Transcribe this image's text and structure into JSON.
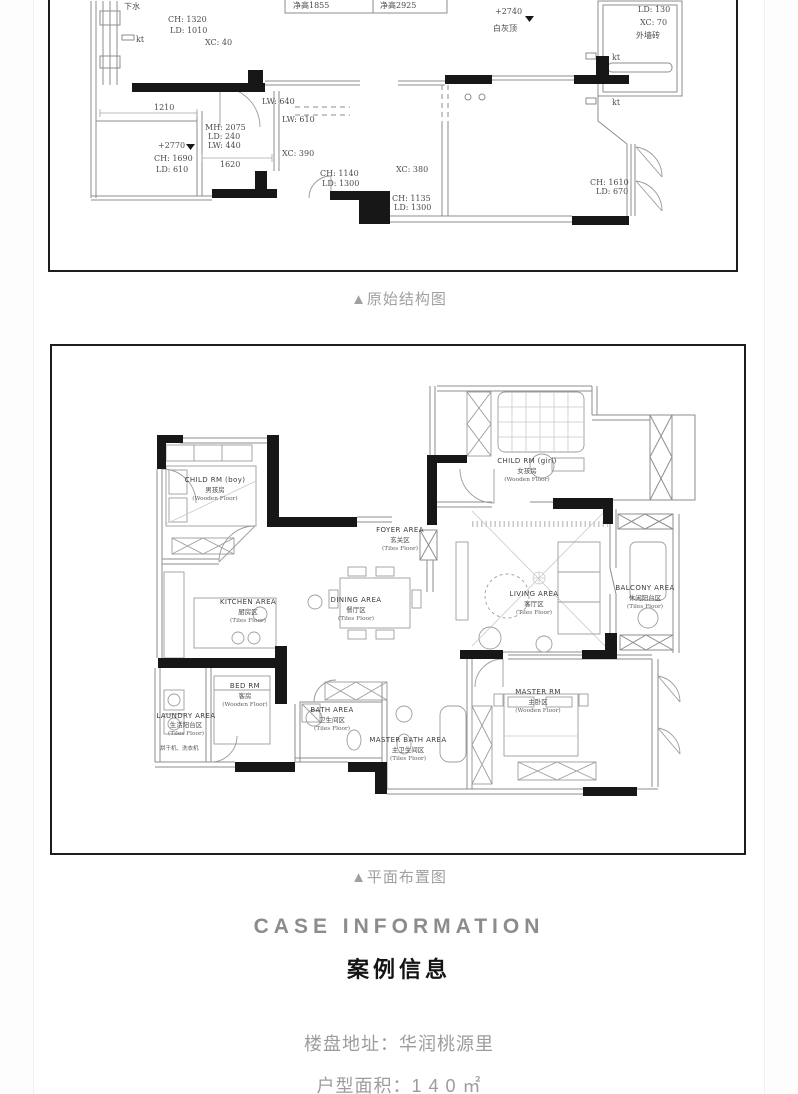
{
  "page": {
    "captions": {
      "plan1": "▲原始结构图",
      "plan2": "▲平面布置图"
    },
    "section": {
      "title_en": "CASE INFORMATION",
      "title_zh": "案例信息"
    },
    "info_lines": [
      "楼盘地址：华润桃源里",
      "户型面积：1 4 0 ㎡"
    ],
    "colors": {
      "frame_border": "#1d1d1d",
      "caption_gray": "#a0a0a0",
      "title_gray": "#8c8c8c",
      "body_gray": "#9c9c9c",
      "ink": "#171717"
    }
  },
  "plan1": {
    "title": "原始结构图",
    "ann": [
      "下水",
      "CH: 1320",
      "LD: 1010",
      "XC: 40",
      "净高1855",
      "净高2925",
      "+2740",
      "白灰顶",
      "LD: 130",
      "XC: 70",
      "外墙砖",
      "LW: 640",
      "LW: 610",
      "1210",
      "MH: 2075",
      "LD: 240",
      "LW: 440",
      "+2770",
      "CH: 1690",
      "LD: 610",
      "1620",
      "XC: 390",
      "CH: 1140",
      "LD: 1300",
      "XC: 380",
      "CH: 1135",
      "LD: 1300",
      "CH: 1610",
      "LD: 670",
      "kt",
      "kt",
      "kt"
    ]
  },
  "plan2": {
    "title": "平面布置图",
    "rooms": [
      {
        "en": "CHILD RM (boy)",
        "zh": "男孩房",
        "floor": "(Wooden Floor)"
      },
      {
        "en": "CHILD RM (girl)",
        "zh": "女孩房",
        "floor": "(Wooden Floor)"
      },
      {
        "en": "FOYER AREA",
        "zh": "玄关区",
        "floor": "(Tiles Floor)"
      },
      {
        "en": "KITCHEN AREA",
        "zh": "厨房区",
        "floor": "(Tiles Floor)"
      },
      {
        "en": "DINING AREA",
        "zh": "餐厅区",
        "floor": "(Tiles Floor)"
      },
      {
        "en": "LIVING AREA",
        "zh": "客厅区",
        "floor": "(Tiles Floor)"
      },
      {
        "en": "BALCONY AREA",
        "zh": "休闲阳台区",
        "floor": "(Tiles Floor)"
      },
      {
        "en": "BED RM",
        "zh": "客房",
        "floor": "(Wooden Floor)"
      },
      {
        "en": "LAUNDRY AREA",
        "zh": "生活阳台区",
        "floor": "(Tiles Floor)"
      },
      {
        "en": "BATH AREA",
        "zh": "卫生间区",
        "floor": "(Tiles Floor)"
      },
      {
        "en": "MASTER BATH AREA",
        "zh": "主卫生间区",
        "floor": "(Tiles Floor)"
      },
      {
        "en": "MASTER RM",
        "zh": "主卧区",
        "floor": "(Wooden Floor)"
      }
    ],
    "notes": [
      "烘干机、洗衣机"
    ]
  }
}
